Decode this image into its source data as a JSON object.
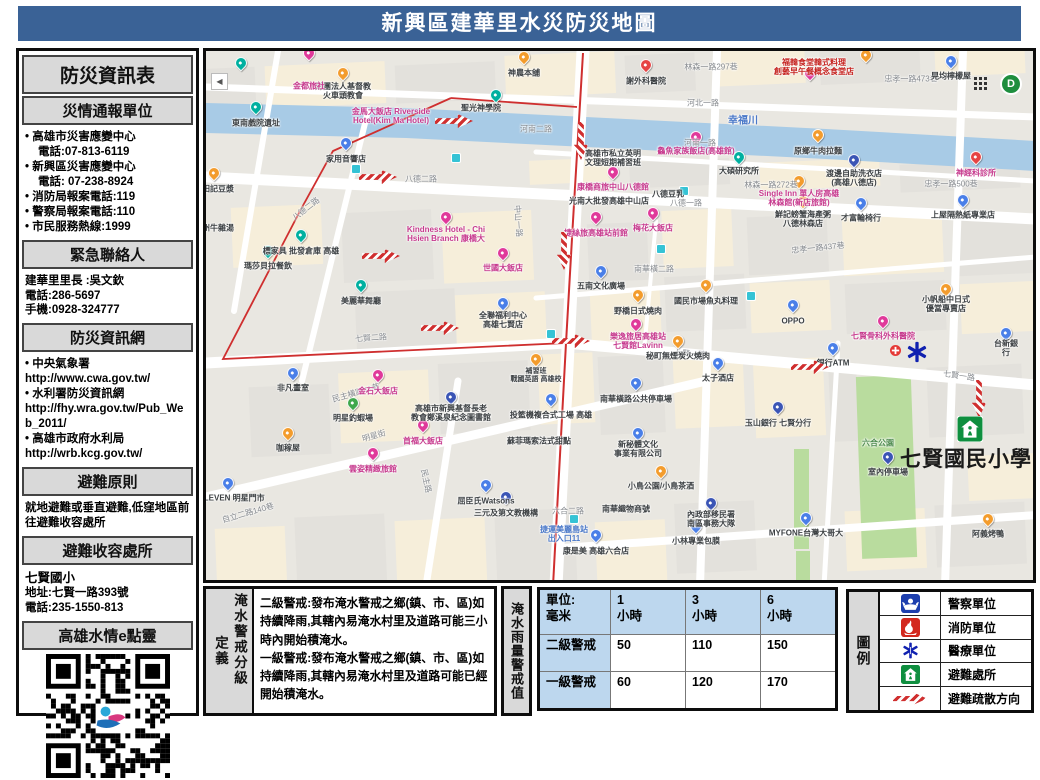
{
  "header": {
    "title": "新興區建華里水災防災地圖"
  },
  "sidebar": {
    "title": "防災資訊表",
    "report": {
      "header": "災情通報單位",
      "items": [
        "• 高雄市災害應變中心",
        "電話:07-813-6119",
        "• 新興區災害應變中心",
        "電話: 07-238-8924",
        "• 消防局報案電話:119",
        "• 警察局報案電話:110",
        "• 市民服務熱線:1999"
      ]
    },
    "contact": {
      "header": "緊急聯絡人",
      "lines": [
        "建華里里長 :吳文欽",
        "電話:286-5697",
        "手機:0928-324777"
      ]
    },
    "web": {
      "header": "防災資訊網",
      "lines": [
        "• 中央氣象署",
        "http://www.cwa.gov.tw/",
        "• 水利署防災資訊網",
        "http://fhy.wra.gov.tw/Pub_Web_2011/",
        "• 高雄市政府水利局",
        "http://wrb.kcg.gov.tw/"
      ]
    },
    "principle": {
      "header": "避難原則",
      "text": "就地避難或垂直避難,低窪地區前往避難收容處所"
    },
    "shelter": {
      "header": "避難收容處所",
      "name": "七賢國小",
      "lines": [
        "地址:七賢一路393號",
        "電話:235-1550-813"
      ]
    },
    "qr": {
      "header": "高雄水情e點靈"
    }
  },
  "definition": {
    "label": "淹水警戒分級",
    "label2": "定義",
    "level2": "二級警戒:發布淹水警戒之鄉(鎮、市、區)如持續降雨,其轄內易淹水村里及道路可能三小時內開始積淹水。",
    "level1": "一級警戒:發布淹水警戒之鄉(鎮、市、區)如持續降雨,其轄內易淹水村里及道路可能已經開始積淹水。"
  },
  "rain_table": {
    "label": "淹水雨量警戒值",
    "unit_header": "單位:\n毫米",
    "headers": [
      "1\n小時",
      "3\n小時",
      "6\n小時"
    ],
    "rows": [
      {
        "label": "二級警戒",
        "values": [
          "50",
          "110",
          "150"
        ]
      },
      {
        "label": "一級警戒",
        "values": [
          "60",
          "120",
          "170"
        ]
      }
    ]
  },
  "legend": {
    "label": "圖例",
    "items": [
      {
        "icon": "police-icon",
        "label": "警察單位"
      },
      {
        "icon": "fire-icon",
        "label": "消防單位"
      },
      {
        "icon": "medical-icon",
        "label": "醫療單位"
      },
      {
        "icon": "shelter-icon",
        "label": "避難處所"
      },
      {
        "icon": "evacuation-arrow-icon",
        "label": "避難疏散方向"
      }
    ]
  },
  "map": {
    "controls": {
      "back": "◀",
      "d_badge": "D"
    },
    "colors": {
      "pink": "#e0399a",
      "blue": "#4a7fe8",
      "orange": "#f39c2d",
      "teal": "#00b0a0",
      "red": "#e64444",
      "green": "#3fa84c",
      "navy": "#3b55b5"
    },
    "labels": [
      {
        "t": "幸福川",
        "x": 537,
        "y": 70,
        "c": "bl",
        "s": 10
      },
      {
        "t": "河北一路",
        "x": 497,
        "y": 52,
        "c": "st"
      },
      {
        "t": "河南一路",
        "x": 494,
        "y": 92,
        "c": "st"
      },
      {
        "t": "河南二路",
        "x": 330,
        "y": 78,
        "c": "st"
      },
      {
        "t": "八德二路",
        "x": 215,
        "y": 128,
        "c": "st"
      },
      {
        "t": "八德二路",
        "x": 100,
        "y": 158,
        "c": "st",
        "r": -38
      },
      {
        "t": "八德一路",
        "x": 480,
        "y": 152,
        "c": "st"
      },
      {
        "t": "七賢二路",
        "x": 165,
        "y": 287,
        "c": "st",
        "r": -4
      },
      {
        "t": "七賢一路",
        "x": 484,
        "y": 303,
        "c": "st",
        "r": 4
      },
      {
        "t": "七賢一路",
        "x": 753,
        "y": 325,
        "c": "st",
        "r": 8
      },
      {
        "t": "中山一路",
        "x": 312,
        "y": 170,
        "c": "st",
        "r": 86
      },
      {
        "t": "林森一路297巷",
        "x": 505,
        "y": 16,
        "c": "st"
      },
      {
        "t": "忠孝一路473巷",
        "x": 705,
        "y": 28,
        "c": "st"
      },
      {
        "t": "林森一路272巷",
        "x": 565,
        "y": 134,
        "c": "st"
      },
      {
        "t": "忠孝一路500巷",
        "x": 745,
        "y": 133,
        "c": "st"
      },
      {
        "t": "忠孝一路437巷",
        "x": 612,
        "y": 197,
        "c": "st",
        "r": -6
      },
      {
        "t": "南華橫二路",
        "x": 448,
        "y": 218,
        "c": "st"
      },
      {
        "t": "民主橫路41巷",
        "x": 150,
        "y": 342,
        "c": "st",
        "r": -16
      },
      {
        "t": "明星街",
        "x": 168,
        "y": 385,
        "c": "st",
        "r": -16
      },
      {
        "t": "民主路",
        "x": 220,
        "y": 430,
        "c": "st",
        "r": 78
      },
      {
        "t": "六合二路",
        "x": 362,
        "y": 460,
        "c": "st"
      },
      {
        "t": "自立二路140巷",
        "x": 42,
        "y": 462,
        "c": "st",
        "r": -16
      },
      {
        "t": "神農本舖",
        "x": 318,
        "y": 22
      },
      {
        "t": "財團法人基督教\n火車頭教會",
        "x": 137,
        "y": 40
      },
      {
        "t": "東南戲院遺址",
        "x": 50,
        "y": 72
      },
      {
        "t": "聖光神學院",
        "x": 275,
        "y": 57
      },
      {
        "t": "謝外科醫院",
        "x": 440,
        "y": 30
      },
      {
        "t": "晃均檸檬屋",
        "x": 745,
        "y": 25
      },
      {
        "t": "福韓食堂韓式料理\n創藝早午餐概念食堂店",
        "x": 608,
        "y": 16,
        "c": "rd"
      },
      {
        "t": "金都旅社",
        "x": 103,
        "y": 35,
        "c": "pk"
      },
      {
        "t": "金馬大飯店 Riverside\nHotel(Kim Ma Hotel)",
        "x": 185,
        "y": 65,
        "c": "pk"
      },
      {
        "t": "神經科診所",
        "x": 770,
        "y": 122,
        "c": "pk"
      },
      {
        "t": "原鄉牛肉拉麵",
        "x": 612,
        "y": 100
      },
      {
        "t": "鱻魚家族飯店(高雄館)",
        "x": 490,
        "y": 100,
        "c": "pk"
      },
      {
        "t": "康橋商旅中山八德館",
        "x": 407,
        "y": 136,
        "c": "pk"
      },
      {
        "t": "高雄市私立英明\n文理短期補習班",
        "x": 407,
        "y": 107
      },
      {
        "t": "大碩研究所",
        "x": 533,
        "y": 120
      },
      {
        "t": "渡邊自助洗衣店\n(高雄八德店)",
        "x": 648,
        "y": 127
      },
      {
        "t": "Single Inn 單人房高雄\n林森館(新店旅館)",
        "x": 593,
        "y": 147,
        "c": "pk"
      },
      {
        "t": "八德豆乳",
        "x": 462,
        "y": 143
      },
      {
        "t": "鮮記螃蟹海產粥\n八德林森店",
        "x": 597,
        "y": 168
      },
      {
        "t": "才富輪椅行",
        "x": 655,
        "y": 167
      },
      {
        "t": "上屋隔熱紙專業店",
        "x": 757,
        "y": 164
      },
      {
        "t": "光南大批發高雄中山店",
        "x": 403,
        "y": 150
      },
      {
        "t": "家用音響店",
        "x": 140,
        "y": 108
      },
      {
        "t": "田記豆漿",
        "x": 12,
        "y": 138
      },
      {
        "t": "潮州牛雜湯",
        "x": 8,
        "y": 177
      },
      {
        "t": "標家具 批發倉庫 高雄",
        "x": 95,
        "y": 200
      },
      {
        "t": "瑪莎貝拉餐飲",
        "x": 62,
        "y": 215
      },
      {
        "t": "世國大飯店",
        "x": 297,
        "y": 217,
        "c": "pk"
      },
      {
        "t": "Kindness Hotel - Chi\nHsien Branch 康橋大",
        "x": 240,
        "y": 183,
        "c": "pk"
      },
      {
        "t": "捷絲旅高雄站前館",
        "x": 390,
        "y": 182,
        "c": "pk"
      },
      {
        "t": "梅花大飯店",
        "x": 447,
        "y": 177,
        "c": "pk"
      },
      {
        "t": "五南文化廣場",
        "x": 395,
        "y": 235
      },
      {
        "t": "美麗華舞廳",
        "x": 155,
        "y": 250
      },
      {
        "t": "全聯福利中心\n高雄七賢店",
        "x": 297,
        "y": 269
      },
      {
        "t": "高雄市新興基督長老\n教會鄭溪泉紀念圖書館",
        "x": 245,
        "y": 362
      },
      {
        "t": "補習班\n戰國英語 高雄校",
        "x": 330,
        "y": 325,
        "s": 7
      },
      {
        "t": "投籃機複合式工場 高雄",
        "x": 345,
        "y": 364
      },
      {
        "t": "蘇菲瑪索法式甜點",
        "x": 333,
        "y": 390
      },
      {
        "t": "金石大飯店",
        "x": 172,
        "y": 340,
        "c": "pk"
      },
      {
        "t": "非凡畫室",
        "x": 87,
        "y": 337
      },
      {
        "t": "明星釣蝦場",
        "x": 147,
        "y": 367
      },
      {
        "t": "首福大飯店",
        "x": 217,
        "y": 390,
        "c": "pk"
      },
      {
        "t": "雲姿精緻旅館",
        "x": 167,
        "y": 418,
        "c": "pk"
      },
      {
        "t": "咖稼屋",
        "x": 82,
        "y": 397
      },
      {
        "t": "7-ELEVEN 明星門市",
        "x": 22,
        "y": 447
      },
      {
        "t": "屈臣氏Watsons",
        "x": 280,
        "y": 450
      },
      {
        "t": "三元及第文教機構",
        "x": 300,
        "y": 462
      },
      {
        "t": "捷運美麗島站\n出入口11",
        "x": 358,
        "y": 483,
        "c": "bl"
      },
      {
        "t": "康是美 高雄六合店",
        "x": 390,
        "y": 500
      },
      {
        "t": "野橋日式燒肉",
        "x": 432,
        "y": 260
      },
      {
        "t": "國民市場魚丸料理",
        "x": 500,
        "y": 250
      },
      {
        "t": "秘町無煙炭火燒肉",
        "x": 472,
        "y": 305
      },
      {
        "t": "樂逸旅居高雄站\n七賢館Lavinn",
        "x": 432,
        "y": 290,
        "c": "pk"
      },
      {
        "t": "OPPO",
        "x": 587,
        "y": 270
      },
      {
        "t": "七賢骨科外科醫院",
        "x": 677,
        "y": 285,
        "c": "pk"
      },
      {
        "t": "銀行ATM",
        "x": 627,
        "y": 312
      },
      {
        "t": "台新銀行",
        "x": 800,
        "y": 297
      },
      {
        "t": "太子酒店",
        "x": 512,
        "y": 327
      },
      {
        "t": "南華橫路公共停車場",
        "x": 430,
        "y": 348
      },
      {
        "t": "玉山銀行 七賢分行",
        "x": 572,
        "y": 372
      },
      {
        "t": "新秘體文化\n事業有限公司",
        "x": 432,
        "y": 398
      },
      {
        "t": "六合公園",
        "x": 672,
        "y": 392,
        "c": "grn"
      },
      {
        "t": "室內停車場",
        "x": 682,
        "y": 421
      },
      {
        "t": "小帆船中日式\n優當專賣店",
        "x": 740,
        "y": 253
      },
      {
        "t": "小鳥公園/小鳥茶酒",
        "x": 455,
        "y": 435
      },
      {
        "t": "南華織物商號",
        "x": 420,
        "y": 458
      },
      {
        "t": "內政部移民署\n南區事務大隊",
        "x": 505,
        "y": 468
      },
      {
        "t": "MYFONE台灣大哥大",
        "x": 600,
        "y": 482
      },
      {
        "t": "小林專業包膜",
        "x": 490,
        "y": 490
      },
      {
        "t": "阿義烤鴨",
        "x": 782,
        "y": 483
      },
      {
        "t": "七賢國民小學",
        "x": 760,
        "y": 409,
        "c": "big"
      }
    ],
    "pins": [
      {
        "x": 103,
        "y": 8,
        "c": "pink"
      },
      {
        "x": 318,
        "y": 12,
        "c": "orange"
      },
      {
        "x": 35,
        "y": 18,
        "c": "teal"
      },
      {
        "x": 137,
        "y": 28,
        "c": "orange"
      },
      {
        "x": 290,
        "y": 50,
        "c": "teal"
      },
      {
        "x": 50,
        "y": 62,
        "c": "teal"
      },
      {
        "x": 440,
        "y": 20,
        "c": "red"
      },
      {
        "x": 604,
        "y": 28,
        "c": "pink"
      },
      {
        "x": 745,
        "y": 16,
        "c": "blue"
      },
      {
        "x": 660,
        "y": 10,
        "c": "orange"
      },
      {
        "x": 612,
        "y": 90,
        "c": "orange"
      },
      {
        "x": 770,
        "y": 112,
        "c": "red"
      },
      {
        "x": 490,
        "y": 92,
        "c": "pink"
      },
      {
        "x": 407,
        "y": 127,
        "c": "pink"
      },
      {
        "x": 533,
        "y": 112,
        "c": "teal"
      },
      {
        "x": 648,
        "y": 115,
        "c": "navy"
      },
      {
        "x": 593,
        "y": 136,
        "c": "orange"
      },
      {
        "x": 597,
        "y": 156,
        "c": "orange"
      },
      {
        "x": 655,
        "y": 158,
        "c": "blue"
      },
      {
        "x": 757,
        "y": 155,
        "c": "blue"
      },
      {
        "x": 140,
        "y": 98,
        "c": "blue"
      },
      {
        "x": 8,
        "y": 128,
        "c": "orange"
      },
      {
        "x": 95,
        "y": 190,
        "c": "teal"
      },
      {
        "x": 62,
        "y": 206,
        "c": "teal"
      },
      {
        "x": 297,
        "y": 208,
        "c": "pink"
      },
      {
        "x": 240,
        "y": 172,
        "c": "pink"
      },
      {
        "x": 390,
        "y": 172,
        "c": "pink"
      },
      {
        "x": 447,
        "y": 168,
        "c": "pink"
      },
      {
        "x": 395,
        "y": 226,
        "c": "blue"
      },
      {
        "x": 155,
        "y": 240,
        "c": "teal"
      },
      {
        "x": 297,
        "y": 258,
        "c": "blue"
      },
      {
        "x": 245,
        "y": 352,
        "c": "navy"
      },
      {
        "x": 147,
        "y": 358,
        "c": "green"
      },
      {
        "x": 172,
        "y": 330,
        "c": "pink"
      },
      {
        "x": 87,
        "y": 328,
        "c": "blue"
      },
      {
        "x": 217,
        "y": 380,
        "c": "pink"
      },
      {
        "x": 167,
        "y": 408,
        "c": "pink"
      },
      {
        "x": 82,
        "y": 388,
        "c": "orange"
      },
      {
        "x": 22,
        "y": 438,
        "c": "blue"
      },
      {
        "x": 280,
        "y": 440,
        "c": "blue"
      },
      {
        "x": 300,
        "y": 452,
        "c": "navy"
      },
      {
        "x": 390,
        "y": 490,
        "c": "blue"
      },
      {
        "x": 512,
        "y": 318,
        "c": "blue"
      },
      {
        "x": 572,
        "y": 362,
        "c": "navy"
      },
      {
        "x": 432,
        "y": 388,
        "c": "blue"
      },
      {
        "x": 682,
        "y": 412,
        "c": "navy"
      },
      {
        "x": 587,
        "y": 260,
        "c": "blue"
      },
      {
        "x": 677,
        "y": 276,
        "c": "pink"
      },
      {
        "x": 627,
        "y": 303,
        "c": "blue"
      },
      {
        "x": 600,
        "y": 473,
        "c": "blue"
      },
      {
        "x": 505,
        "y": 458,
        "c": "navy"
      },
      {
        "x": 490,
        "y": 481,
        "c": "blue"
      },
      {
        "x": 455,
        "y": 426,
        "c": "orange"
      },
      {
        "x": 782,
        "y": 474,
        "c": "orange"
      },
      {
        "x": 800,
        "y": 288,
        "c": "blue"
      },
      {
        "x": 345,
        "y": 354,
        "c": "blue"
      },
      {
        "x": 330,
        "y": 314,
        "c": "orange"
      },
      {
        "x": 430,
        "y": 338,
        "c": "blue"
      },
      {
        "x": 472,
        "y": 296,
        "c": "orange"
      },
      {
        "x": 430,
        "y": 279,
        "c": "pink"
      },
      {
        "x": 432,
        "y": 250,
        "c": "orange"
      },
      {
        "x": 500,
        "y": 240,
        "c": "orange"
      },
      {
        "x": 740,
        "y": 244,
        "c": "orange"
      }
    ],
    "transit": [
      {
        "x": 250,
        "y": 107
      },
      {
        "x": 150,
        "y": 118
      },
      {
        "x": 345,
        "y": 283
      },
      {
        "x": 455,
        "y": 198
      },
      {
        "x": 545,
        "y": 245
      },
      {
        "x": 478,
        "y": 140
      },
      {
        "x": 368,
        "y": 468
      }
    ],
    "arrows": [
      {
        "x": 248,
        "y": 70,
        "d": "r"
      },
      {
        "x": 172,
        "y": 126,
        "d": "r"
      },
      {
        "x": 175,
        "y": 205,
        "d": "r"
      },
      {
        "x": 234,
        "y": 277,
        "d": "r"
      },
      {
        "x": 365,
        "y": 290,
        "d": "r"
      },
      {
        "x": 604,
        "y": 316,
        "d": "r"
      },
      {
        "x": 375,
        "y": 90,
        "d": "d"
      },
      {
        "x": 358,
        "y": 200,
        "d": "d"
      },
      {
        "x": 773,
        "y": 348,
        "d": "d"
      }
    ],
    "icons": [
      {
        "t": "back",
        "x": 5,
        "y": 22
      },
      {
        "t": "grid",
        "x": 768,
        "y": 26
      },
      {
        "t": "dmark",
        "x": 794,
        "y": 22
      },
      {
        "t": "star",
        "x": 700,
        "y": 290
      },
      {
        "t": "cross",
        "x": 684,
        "y": 292
      },
      {
        "t": "shelter",
        "x": 751,
        "y": 365
      }
    ]
  }
}
